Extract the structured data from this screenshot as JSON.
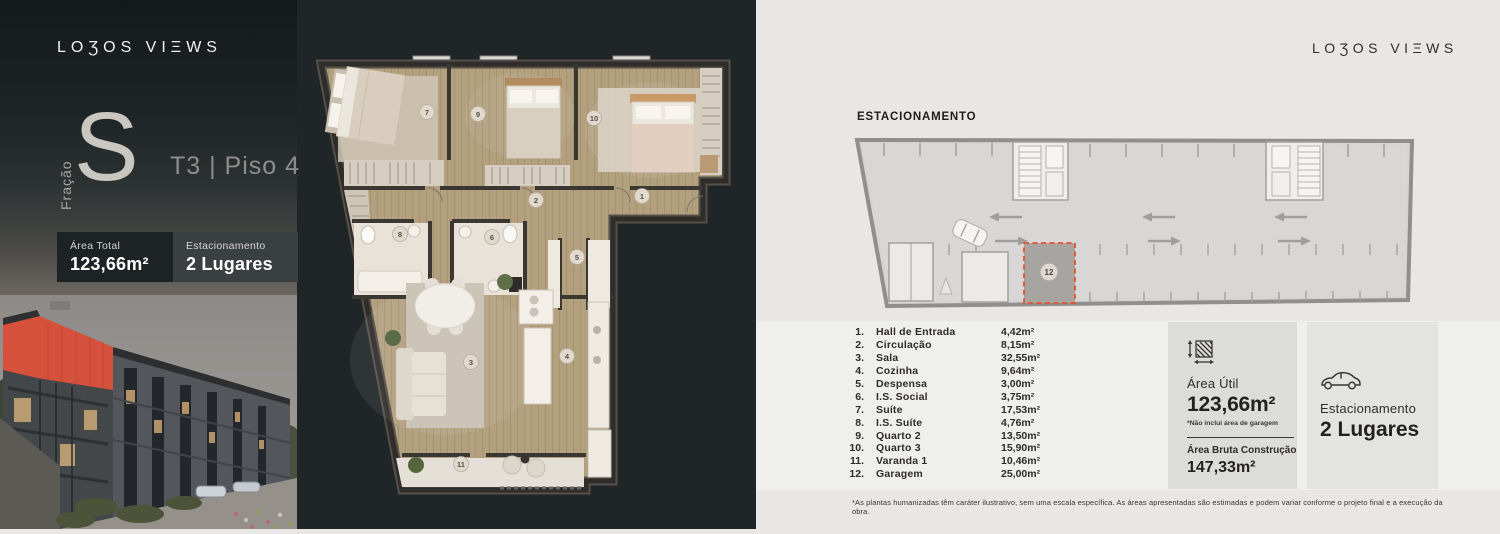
{
  "left_panel": {
    "logo": "LOƷOS VIΞWS",
    "fraction_label": "Fração",
    "fraction_letter": "S",
    "type_floor": "T3 | Piso 4",
    "badges": [
      {
        "label": "Área Total",
        "value": "123,66m²"
      },
      {
        "label": "Estacionamento",
        "value": "2 Lugares"
      }
    ]
  },
  "floor_plan": {
    "numbers": [
      "1",
      "2",
      "3",
      "4",
      "5",
      "6",
      "7",
      "8",
      "9",
      "10",
      "11"
    ]
  },
  "right_panel": {
    "logo": "LOƷOS VIΞWS",
    "parking_title": "ESTACIONAMENTO",
    "parking_space_number": "12",
    "rooms": [
      {
        "num": "1.",
        "name": "Hall de Entrada",
        "area": "4,42m²"
      },
      {
        "num": "2.",
        "name": "Circulação",
        "area": "8,15m²"
      },
      {
        "num": "3.",
        "name": "Sala",
        "area": "32,55m²"
      },
      {
        "num": "4.",
        "name": "Cozinha",
        "area": "9,64m²"
      },
      {
        "num": "5.",
        "name": "Despensa",
        "area": "3,00m²"
      },
      {
        "num": "6.",
        "name": "I.S. Social",
        "area": "3,75m²"
      },
      {
        "num": "7.",
        "name": "Suíte",
        "area": "17,53m²"
      },
      {
        "num": "8.",
        "name": "I.S. Suíte",
        "area": "4,76m²"
      },
      {
        "num": "9.",
        "name": "Quarto 2",
        "area": "13,50m²"
      },
      {
        "num": "10.",
        "name": "Quarto 3",
        "area": "15,90m²"
      },
      {
        "num": "11.",
        "name": "Varanda 1",
        "area": "10,46m²"
      },
      {
        "num": "12.",
        "name": "Garagem",
        "area": "25,00m²"
      }
    ],
    "area_box": {
      "label": "Área Útil",
      "value": "123,66m²",
      "note": "*Não inclui área de garagem",
      "gross_label": "Área Bruta Construção",
      "gross_value": "147,33m²"
    },
    "parking_box": {
      "label": "Estacionamento",
      "value": "2 Lugares"
    },
    "disclaimer": "*As plantas humanizadas têm caráter ilustrativo, sem uma escala específica. As áreas apresentadas são estimadas e podem variar conforme o projeto final e a execução da obra."
  },
  "colors": {
    "dark_bg": "#202627",
    "light_bg": "#e8e7e5",
    "highlight_red": "#e0502e",
    "wood_floor": "#b2a07f"
  }
}
